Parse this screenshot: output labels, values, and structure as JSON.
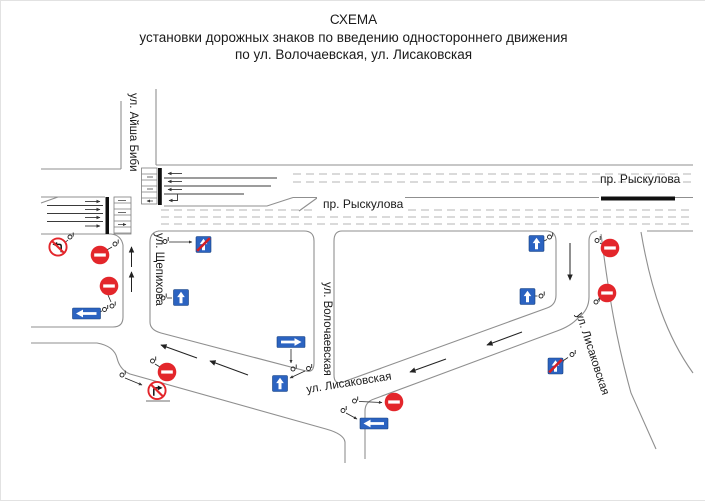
{
  "title": {
    "line1": "СХЕМА",
    "line2": "установки дорожных знаков по введению одностороннего движения",
    "line3": "по ул. Волочаевская, ул. Лисаковская"
  },
  "streets": {
    "aisha_bibi": "ул. Айша Биби",
    "ryskulova_center": "пр. Рыскулова",
    "ryskulova_right": "пр. Рыскулова",
    "shchepikhova": "ул. Щепихова",
    "volochaevskaya": "ул. Волочаевская",
    "lisakovskaya_bottom": "ул. Лисаковская",
    "lisakovskaya_right": "ул. Лисаковская"
  },
  "sign_types": {
    "no_entry": "no-entry-sign",
    "one_way_up": "one-way-road-sign",
    "one_way_end": "end-of-one-way-road-sign",
    "exit_right": "one-way-exit-right-sign",
    "exit_left": "one-way-exit-left-sign",
    "no_left_turn": "no-left-turn-sign",
    "no_right_turn": "no-right-turn-sign",
    "post_marker": "sign-post-marker"
  },
  "colors": {
    "sign_blue": "#2b63c1",
    "prohibition_red": "#e3262b",
    "road_line": "#8f8f8f",
    "stop_bar": "#111111",
    "text": "#1a1a1a"
  }
}
